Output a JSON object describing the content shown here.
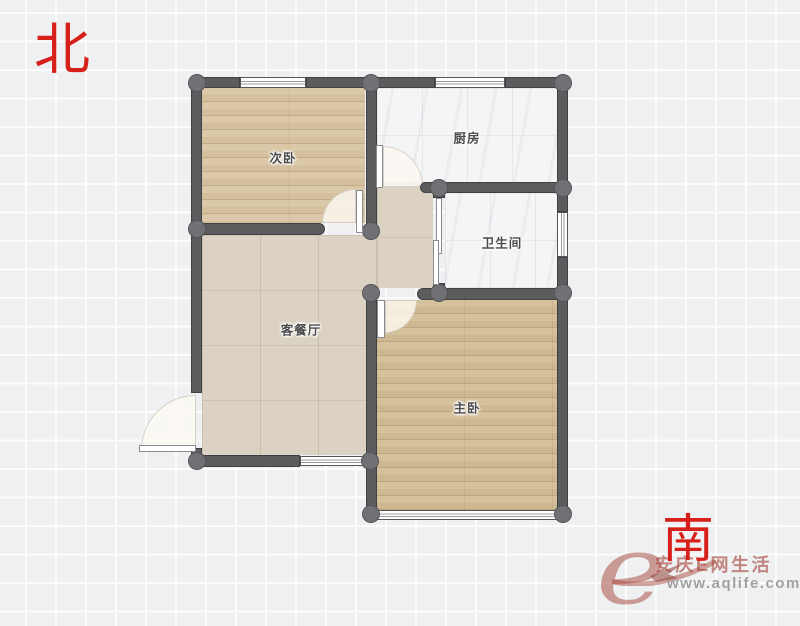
{
  "compass": {
    "north_label": "北",
    "south_label": "南"
  },
  "rooms": [
    {
      "name": "secondary-bedroom",
      "label": "次卧"
    },
    {
      "name": "kitchen",
      "label": "厨房"
    },
    {
      "name": "bathroom",
      "label": "卫生间"
    },
    {
      "name": "living-dining-room",
      "label": "客餐厅"
    },
    {
      "name": "master-bedroom",
      "label": "主卧"
    }
  ],
  "watermark": {
    "logo_letter": "e",
    "site_name": "安庆E网生活",
    "site_url": "www.aqlife.com"
  },
  "colors": {
    "compass-red": "#d7201a",
    "wall": "#5b5c5e",
    "wall-joint": "#707174",
    "wall-edge": "#3f4042",
    "wood-floor": "#d8c4a1",
    "wood-floor-dark": "#d2bc95",
    "white-tile": "#f4f5f6",
    "beige-tile": "#dbd2c3",
    "label-gray": "#4b4b4d",
    "watermark-red": "#a5453a",
    "watermark-gray": "#9d9da0"
  }
}
